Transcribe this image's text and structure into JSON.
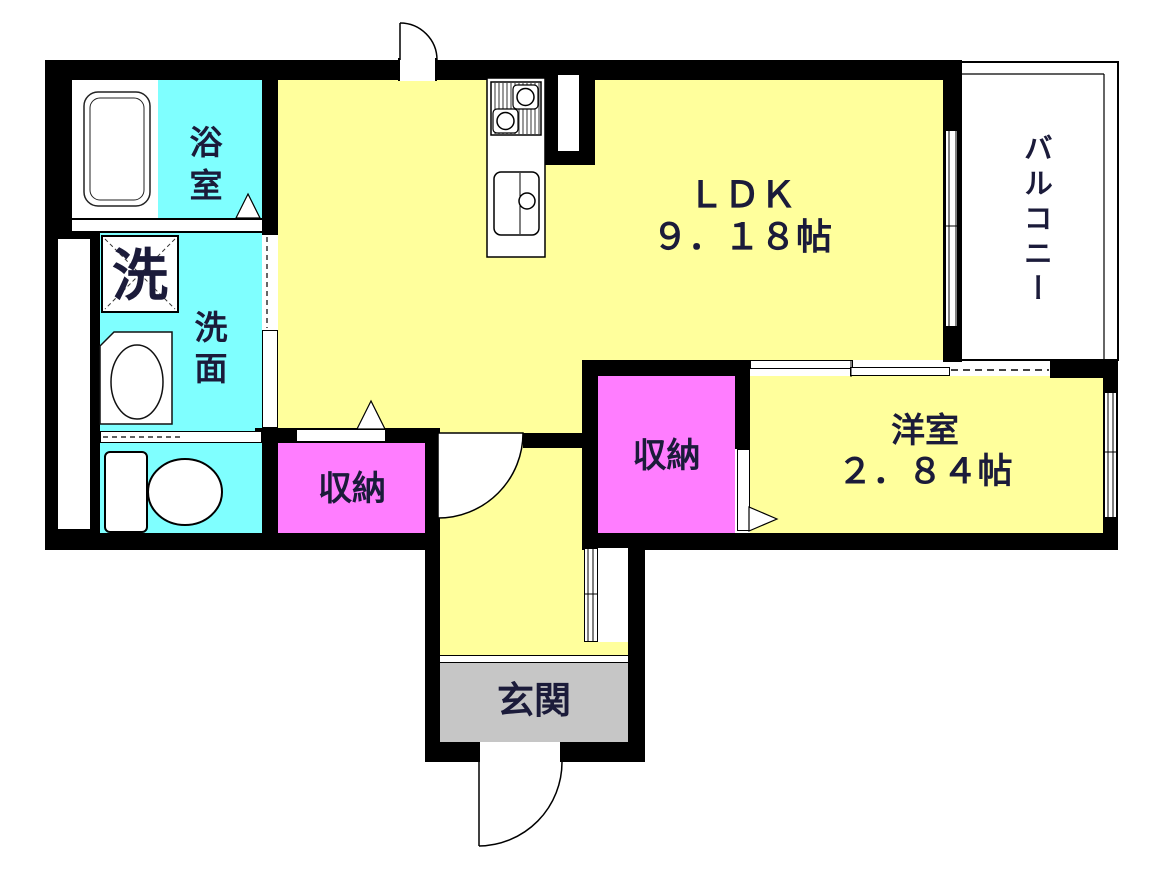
{
  "rooms": {
    "bathroom": {
      "label": "浴室"
    },
    "laundry": {
      "label": "洗"
    },
    "washroom": {
      "label": "洗面"
    },
    "toilet": {
      "label": ""
    },
    "ldk": {
      "label": "ＬＤＫ",
      "size": "９．１８帖"
    },
    "balcony": {
      "label": "バルコニー"
    },
    "storage_hall": {
      "label": "収納"
    },
    "storage_west": {
      "label": "収納"
    },
    "western_room": {
      "label": "洋室",
      "size": "２．８４帖"
    },
    "entrance": {
      "label": "玄関"
    }
  },
  "colors": {
    "room_yellow": "#FFFF9C",
    "wet_area_cyan": "#7FFFFF",
    "storage_pink": "#FF7DFF",
    "entrance_gray": "#C6C6C6",
    "wall_black": "#000000",
    "label_text": "#1B1B3A"
  }
}
